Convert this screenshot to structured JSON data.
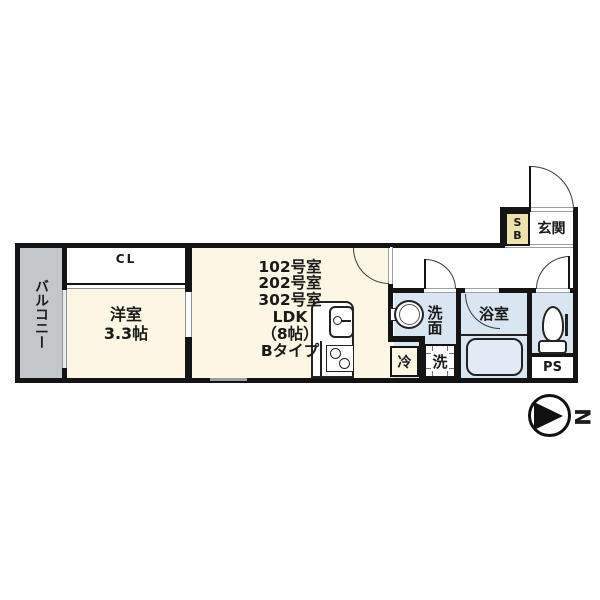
{
  "plan": {
    "rooms": {
      "balcony": {
        "label": "バルコニー"
      },
      "closet": {
        "label": "CL"
      },
      "western_room": {
        "label": "洋室",
        "size": "3.3帖"
      },
      "ldk": {
        "lines": [
          "102号室",
          "202号室",
          "302号室",
          "LDK",
          "（8帖）",
          "Bタイプ"
        ]
      },
      "entrance": {
        "label": "玄関"
      },
      "shoe_box": {
        "label": "SB"
      },
      "washroom": {
        "label": "洗面"
      },
      "washer": {
        "label": "洗"
      },
      "bathroom": {
        "label": "浴室"
      },
      "refrigerator": {
        "label": "冷"
      },
      "pipe_space": {
        "label": "PS"
      }
    },
    "compass": {
      "north_label": "N"
    },
    "colors": {
      "wall": "#141414",
      "room_cream": "#fbf7e4",
      "wet_area_blue": "#d9e5f1",
      "balcony_gray": "#c4c7ca",
      "shoe_box_tan": "#ede2ae",
      "window_gray": "#9aa0a5"
    }
  }
}
